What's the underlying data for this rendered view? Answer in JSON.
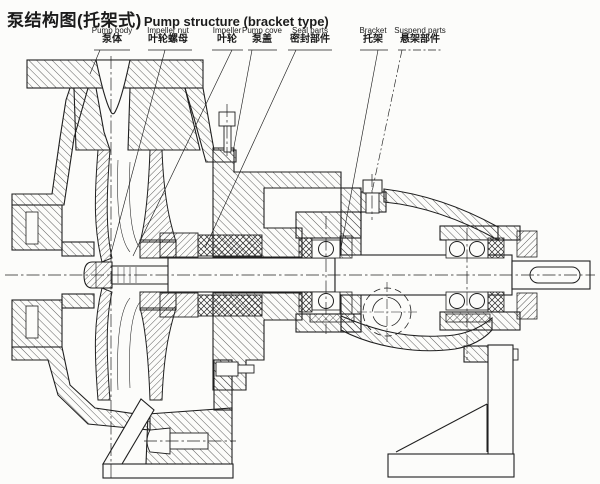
{
  "title": {
    "cjk": "泵结构图(托架式)",
    "en": "Pump structure (bracket type)"
  },
  "labels": [
    {
      "id": "pump-body",
      "en": "Pump body",
      "cjk": "泵体"
    },
    {
      "id": "impeller-nut",
      "en": "Impeller nut",
      "cjk": "叶轮螺母"
    },
    {
      "id": "impeller",
      "en": "Impeller",
      "cjk": "叶轮"
    },
    {
      "id": "pump-cover",
      "en": "Pump cove",
      "cjk": "泵盖"
    },
    {
      "id": "seal-parts",
      "en": "Seal parts",
      "cjk": "密封部件"
    },
    {
      "id": "bracket",
      "en": "Bracket",
      "cjk": "托架"
    },
    {
      "id": "suspend-parts",
      "en": "Suspend parts",
      "cjk": "悬架部件"
    }
  ],
  "colors": {
    "ink": "#1f1f1f",
    "paper": "#fcfcfa"
  }
}
